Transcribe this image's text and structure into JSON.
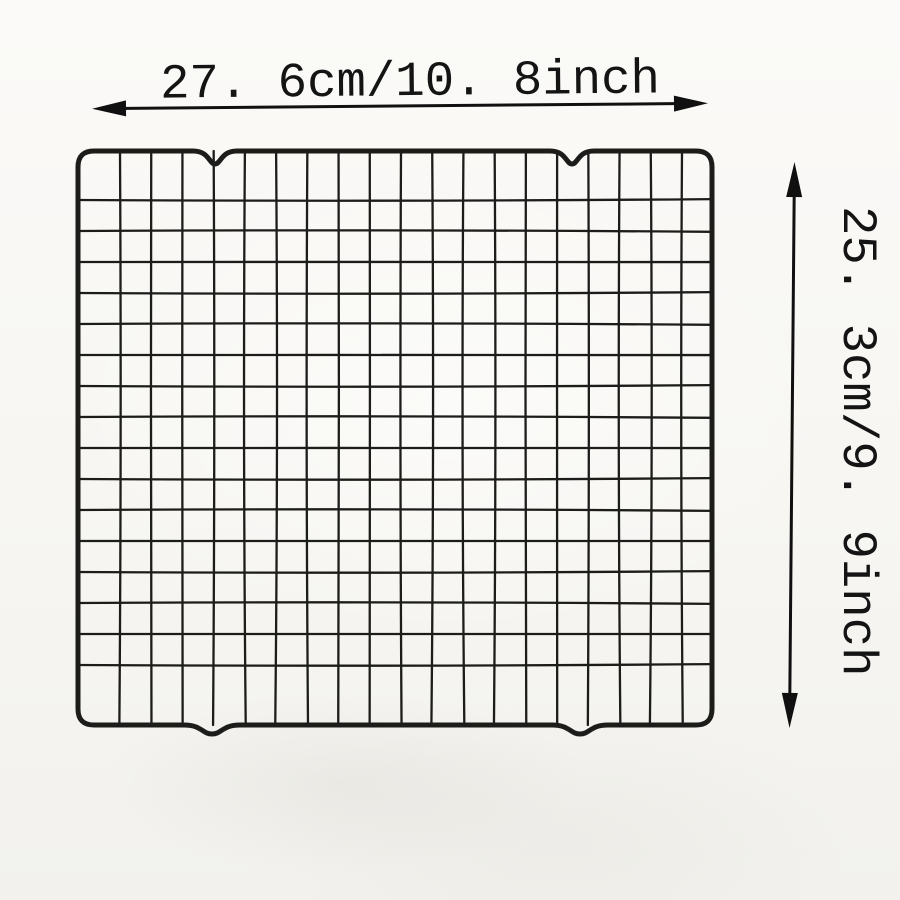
{
  "image_type": "product dimension diagram",
  "product": {
    "name": "grid wire cooling rack",
    "grid_columns": 20,
    "grid_rows": 17,
    "top_notches": 2,
    "bottom_feet": 2,
    "wire_color": "#1c1c1a"
  },
  "dimensions": {
    "width_label": "27. 6cm/10. 8inch",
    "height_label": "25. 3cm/9. 9inch"
  },
  "colors": {
    "arrow": "#101010",
    "text": "#141414",
    "background": "#fbfaf8"
  }
}
